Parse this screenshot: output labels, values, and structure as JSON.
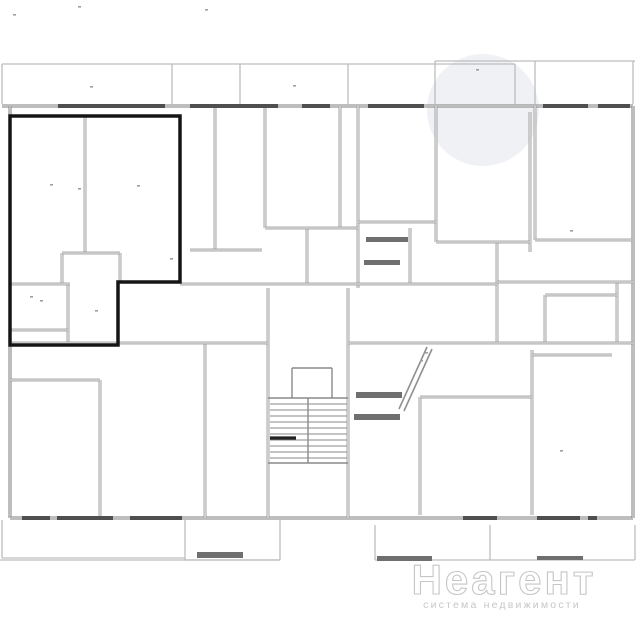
{
  "watermark": {
    "brand": "Неагент",
    "tagline": "система недвижимости",
    "circle_color": "#edf0f4"
  },
  "colors": {
    "background": "#ffffff",
    "balcony": "#bdbdbd",
    "exterior": "#7d7d7d",
    "wall": "#8f8f8f",
    "wall_core": "#fdfdfd",
    "window": "#4f4f4f",
    "highlight": "#151515",
    "furniture": "#6f6f6f",
    "speck": "#9e9e9e",
    "stair": "#8a8a8a",
    "brand_fill": "#ffffff",
    "brand_stroke": "#c6c6c6",
    "tagline_fill": "#c7c7c7"
  },
  "floorplan": {
    "viewbox": "0 0 636 636",
    "highlighted_unit_points": "10,116 180,116 180,282 118,282 118,345 10,345",
    "watermark_circle": {
      "cx": 483,
      "cy": 110,
      "r": 56
    },
    "balcony_lines": [
      [
        2,
        64,
        515,
        64
      ],
      [
        435,
        61,
        635,
        61
      ],
      [
        2,
        64,
        2,
        104
      ],
      [
        172,
        64,
        172,
        104
      ],
      [
        240,
        64,
        240,
        104
      ],
      [
        348,
        64,
        348,
        104
      ],
      [
        435,
        61,
        435,
        104
      ],
      [
        515,
        64,
        515,
        104
      ],
      [
        535,
        61,
        535,
        104
      ],
      [
        633,
        61,
        633,
        104
      ],
      [
        2,
        520,
        2,
        558
      ],
      [
        2,
        558,
        185,
        558
      ],
      [
        0,
        560,
        280,
        560
      ],
      [
        185,
        520,
        185,
        560
      ],
      [
        280,
        520,
        280,
        560
      ],
      [
        185,
        560,
        280,
        560
      ],
      [
        375,
        525,
        375,
        560
      ],
      [
        490,
        525,
        490,
        560
      ],
      [
        635,
        525,
        635,
        560
      ],
      [
        375,
        560,
        635,
        560
      ]
    ],
    "exterior_walls": [
      [
        2,
        106,
        633,
        106
      ],
      [
        10,
        106,
        10,
        518
      ],
      [
        10,
        518,
        633,
        518
      ],
      [
        633,
        106,
        633,
        518
      ]
    ],
    "interior_walls": [
      [
        215,
        106,
        215,
        250
      ],
      [
        265,
        106,
        265,
        228
      ],
      [
        340,
        106,
        340,
        228
      ],
      [
        358,
        106,
        358,
        288
      ],
      [
        436,
        106,
        436,
        242
      ],
      [
        530,
        112,
        530,
        252
      ],
      [
        535,
        106,
        535,
        240
      ],
      [
        497,
        242,
        497,
        343
      ],
      [
        617,
        282,
        617,
        343
      ],
      [
        545,
        295,
        545,
        343
      ],
      [
        307,
        228,
        307,
        284
      ],
      [
        410,
        228,
        410,
        284
      ],
      [
        268,
        288,
        268,
        518
      ],
      [
        348,
        288,
        348,
        518
      ],
      [
        100,
        380,
        100,
        518
      ],
      [
        205,
        343,
        205,
        518
      ],
      [
        420,
        397,
        420,
        515
      ],
      [
        532,
        350,
        532,
        515
      ],
      [
        85,
        116,
        85,
        253
      ],
      [
        62,
        253,
        62,
        284
      ],
      [
        120,
        253,
        120,
        282
      ],
      [
        68,
        284,
        68,
        345
      ],
      [
        190,
        250,
        262,
        250
      ],
      [
        265,
        228,
        358,
        228
      ],
      [
        358,
        222,
        436,
        222
      ],
      [
        180,
        284,
        497,
        284
      ],
      [
        497,
        282,
        633,
        282
      ],
      [
        545,
        295,
        617,
        295
      ],
      [
        10,
        343,
        268,
        343
      ],
      [
        348,
        343,
        633,
        343
      ],
      [
        436,
        242,
        530,
        242
      ],
      [
        535,
        240,
        633,
        240
      ],
      [
        420,
        397,
        532,
        397
      ],
      [
        532,
        355,
        612,
        355
      ],
      [
        10,
        380,
        100,
        380
      ],
      [
        62,
        253,
        120,
        253
      ],
      [
        10,
        284,
        70,
        284
      ],
      [
        10,
        330,
        68,
        330
      ]
    ],
    "diagonal_walls": [
      [
        427,
        347,
        399,
        409
      ],
      [
        432,
        349,
        404,
        411
      ]
    ],
    "windows": [
      [
        58,
        106,
        165,
        106
      ],
      [
        190,
        106,
        278,
        106
      ],
      [
        302,
        106,
        330,
        106
      ],
      [
        368,
        106,
        424,
        106
      ],
      [
        543,
        106,
        588,
        106
      ],
      [
        598,
        106,
        630,
        106
      ],
      [
        22,
        518,
        50,
        518
      ],
      [
        57,
        518,
        113,
        518
      ],
      [
        130,
        518,
        182,
        518
      ],
      [
        463,
        518,
        497,
        518
      ],
      [
        537,
        518,
        580,
        518
      ],
      [
        588,
        518,
        597,
        518
      ]
    ],
    "stairs": {
      "outline": [
        [
          268,
          398,
          348,
          398
        ],
        [
          268,
          463,
          348,
          463
        ]
      ],
      "treads_y": [
        404,
        410,
        416,
        422,
        428,
        434,
        440,
        446,
        452,
        458
      ],
      "tread_x1": 270,
      "tread_x2": 347,
      "divider": [
        308,
        398,
        308,
        463
      ],
      "landing": [
        [
          292,
          368,
          332,
          368
        ],
        [
          292,
          368,
          292,
          398
        ],
        [
          332,
          368,
          332,
          398
        ]
      ],
      "bold_tread": [
        270,
        438,
        296,
        438
      ]
    },
    "furniture_bars": [
      [
        356,
        392,
        46,
        6
      ],
      [
        354,
        414,
        46,
        6
      ],
      [
        366,
        237,
        42,
        5
      ],
      [
        364,
        260,
        36,
        5
      ],
      [
        377,
        556,
        55,
        5
      ],
      [
        537,
        556,
        46,
        4
      ],
      [
        197,
        552,
        46,
        6
      ]
    ],
    "specks": [
      [
        50,
        184
      ],
      [
        78,
        188
      ],
      [
        90,
        86
      ],
      [
        293,
        85
      ],
      [
        137,
        185
      ],
      [
        40,
        300
      ],
      [
        30,
        296
      ],
      [
        95,
        310
      ],
      [
        170,
        258
      ],
      [
        476,
        69
      ],
      [
        420,
        360
      ],
      [
        425,
        352
      ],
      [
        78,
        6
      ],
      [
        13,
        14
      ],
      [
        205,
        9
      ],
      [
        570,
        230
      ],
      [
        560,
        450
      ]
    ]
  }
}
